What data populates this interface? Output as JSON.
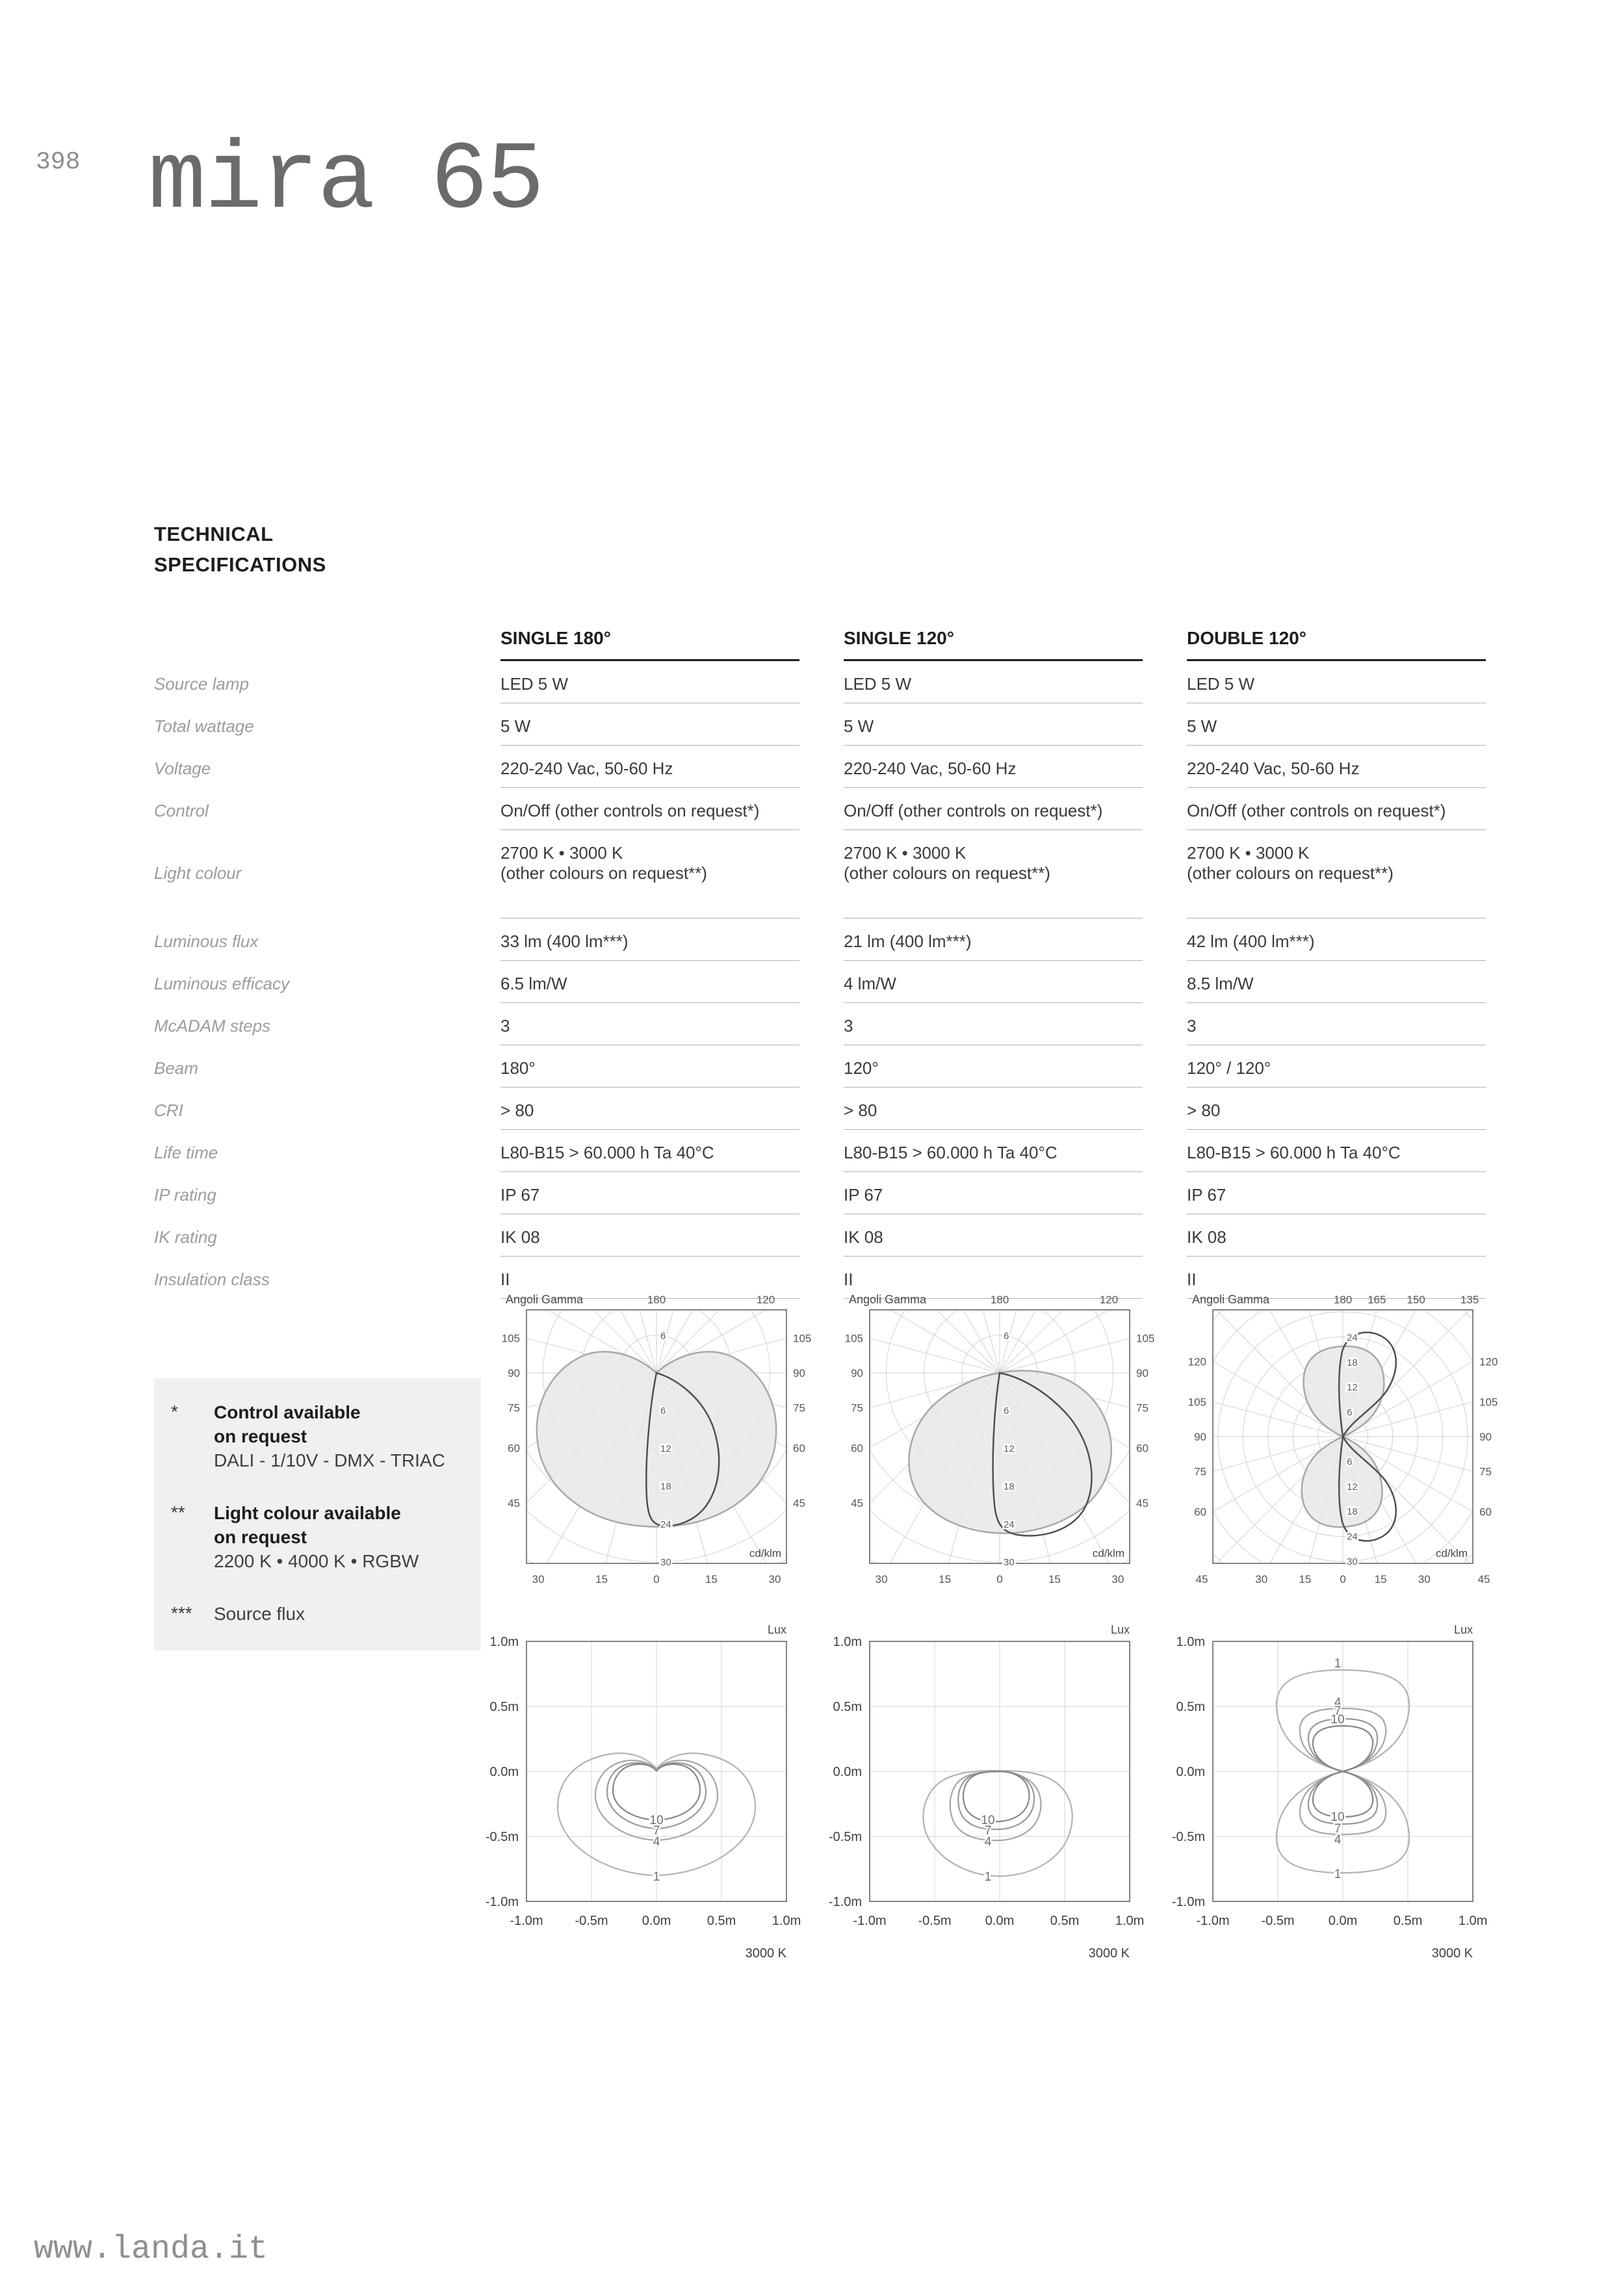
{
  "page": {
    "number": "398",
    "title": "mira 65",
    "section_title": "TECHNICAL\nSPECIFICATIONS",
    "footer_url": "www.landa.it"
  },
  "table": {
    "columns": [
      "SINGLE 180°",
      "SINGLE 120°",
      "DOUBLE 120°"
    ],
    "rows": [
      {
        "label": "Source lamp",
        "values": [
          "LED 5 W",
          "LED 5 W",
          "LED 5 W"
        ]
      },
      {
        "label": "Total wattage",
        "values": [
          "5 W",
          "5 W",
          "5 W"
        ]
      },
      {
        "label": "Voltage",
        "values": [
          "220-240 Vac, 50-60 Hz",
          "220-240 Vac, 50-60 Hz",
          "220-240 Vac, 50-60 Hz"
        ]
      },
      {
        "label": "Control",
        "values": [
          "On/Off (other controls on request*)",
          "On/Off (other controls on request*)",
          "On/Off (other controls on request*)"
        ]
      },
      {
        "label": "Light colour",
        "tall": true,
        "values": [
          "2700 K • 3000 K\n(other colours on request**)",
          "2700 K • 3000 K\n(other colours on request**)",
          "2700 K • 3000 K\n(other colours on request**)"
        ]
      },
      {
        "label": "Luminous flux",
        "values": [
          "33 lm (400 lm***)",
          "21 lm (400 lm***)",
          "42 lm (400 lm***)"
        ]
      },
      {
        "label": "Luminous efficacy",
        "values": [
          "6.5 lm/W",
          "4 lm/W",
          "8.5 lm/W"
        ]
      },
      {
        "label": "McADAM steps",
        "values": [
          "3",
          "3",
          "3"
        ]
      },
      {
        "label": "Beam",
        "values": [
          "180°",
          "120°",
          "120° / 120°"
        ]
      },
      {
        "label": "CRI",
        "values": [
          "> 80",
          "> 80",
          "> 80"
        ]
      },
      {
        "label": "Life time",
        "values": [
          "L80-B15 > 60.000 h Ta 40°C",
          "L80-B15 > 60.000 h Ta 40°C",
          "L80-B15 > 60.000 h Ta 40°C"
        ]
      },
      {
        "label": "IP rating",
        "values": [
          "IP 67",
          "IP 67",
          "IP 67"
        ]
      },
      {
        "label": "IK rating",
        "values": [
          "IK 08",
          "IK 08",
          "IK 08"
        ]
      },
      {
        "label": "Insulation class",
        "values": [
          "II",
          "II",
          "II"
        ]
      }
    ]
  },
  "footnotes": [
    {
      "marker": "*",
      "title": "Control available\non request",
      "detail": "DALI - 1/10V - DMX - TRIAC"
    },
    {
      "marker": "**",
      "title": "Light colour available\non request",
      "detail": "2200 K • 4000 K • RGBW"
    },
    {
      "marker": "***",
      "title": "",
      "detail": "Source flux"
    }
  ],
  "diagrams": {
    "gamma_label": "Angoli Gamma",
    "polar_unit": "cd/klm",
    "lux_unit": "Lux",
    "color_temp": "3000 K",
    "polar": [
      {
        "name": "single-180",
        "top_ticks": [
          "180",
          "120"
        ],
        "side_ticks": [
          "105",
          "90",
          "75",
          "60",
          "45"
        ],
        "bottom_ticks": [
          "30",
          "15",
          "0",
          "15",
          "30"
        ],
        "radial_above": [
          "6"
        ],
        "radial_below": [
          "6",
          "12",
          "18",
          "24",
          "30"
        ]
      },
      {
        "name": "single-120",
        "top_ticks": [
          "180",
          "120"
        ],
        "side_ticks": [
          "105",
          "90",
          "75",
          "60",
          "45"
        ],
        "bottom_ticks": [
          "30",
          "15",
          "0",
          "15",
          "30"
        ],
        "radial_above": [
          "6"
        ],
        "radial_below": [
          "6",
          "12",
          "18",
          "24",
          "30"
        ]
      },
      {
        "name": "double-120",
        "top_ticks": [
          "180",
          "165",
          "150",
          "135"
        ],
        "side_ticks": [
          "120",
          "105",
          "90",
          "75",
          "60"
        ],
        "bottom_ticks": [
          "45",
          "30",
          "15",
          "0",
          "15",
          "30",
          "45"
        ],
        "radial_above": [
          "6",
          "12",
          "18",
          "24"
        ],
        "radial_below": [
          "6",
          "12",
          "18",
          "24",
          "30"
        ]
      }
    ],
    "lux": [
      {
        "name": "single-180",
        "x_ticks": [
          "-1.0m",
          "-0.5m",
          "0.0m",
          "0.5m",
          "1.0m"
        ],
        "y_ticks": [
          "1.0m",
          "0.5m",
          "0.0m",
          "-0.5m",
          "-1.0m"
        ],
        "contour_levels": [
          "10",
          "7",
          "4",
          "1"
        ]
      },
      {
        "name": "single-120",
        "x_ticks": [
          "-1.0m",
          "-0.5m",
          "0.0m",
          "0.5m",
          "1.0m"
        ],
        "y_ticks": [
          "1.0m",
          "0.5m",
          "0.0m",
          "-0.5m",
          "-1.0m"
        ],
        "contour_levels": [
          "10",
          "7",
          "4",
          "1"
        ]
      },
      {
        "name": "double-120",
        "x_ticks": [
          "-1.0m",
          "-0.5m",
          "0.0m",
          "0.5m",
          "1.0m"
        ],
        "y_ticks": [
          "1.0m",
          "0.5m",
          "0.0m",
          "-0.5m",
          "-1.0m"
        ],
        "contour_levels": [
          "10",
          "7",
          "4",
          "1"
        ]
      }
    ]
  }
}
